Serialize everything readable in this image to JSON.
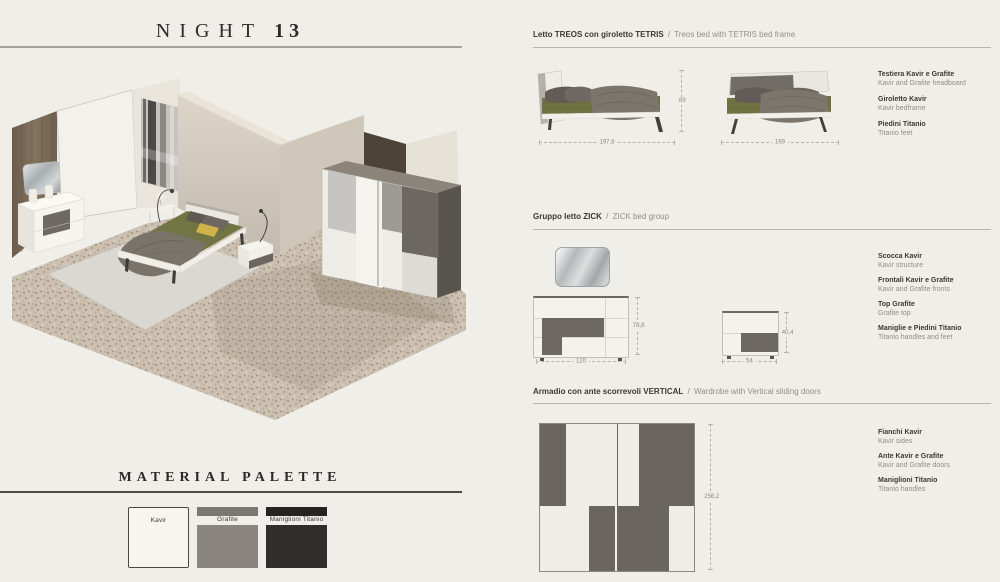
{
  "ui": {
    "sep": "/"
  },
  "title": {
    "text": "NIGHT",
    "number": "13"
  },
  "material_palette": {
    "heading": "MATERIAL PALETTE",
    "swatches": [
      {
        "name": "Kavir",
        "color": "#f7f5f0"
      },
      {
        "name": "Grafite",
        "color": "#8b8580"
      },
      {
        "name": "Maniglioni Titanio",
        "color": "#302e2c"
      }
    ]
  },
  "sections": [
    {
      "title_it": "Letto TREOS con giroletto TETRIS",
      "title_en": "Treos bed with TETRIS bed frame",
      "dims": {
        "side_width": "197,8",
        "height": "89",
        "front_width": "169"
      },
      "labels": [
        {
          "it": "Testiera Kavir e Grafite",
          "en": "Kavir and Grafite headboard"
        },
        {
          "it": "Giroletto Kavir",
          "en": "Kavir bedframe"
        },
        {
          "it": "Piedini Titanio",
          "en": "Titanio feet"
        }
      ]
    },
    {
      "title_it": "Gruppo letto ZICK",
      "title_en": "ZICK bed group",
      "dims": {
        "dresser_height": "78,8",
        "dresser_width": "120",
        "nightstand_height": "40,4",
        "nightstand_width": "54"
      },
      "labels": [
        {
          "it": "Scocca Kavir",
          "en": "Kavir structure"
        },
        {
          "it": "Frontali Kavir e Grafite",
          "en": "Kavir and Grafite fronts"
        },
        {
          "it": "Top Grafite",
          "en": "Grafite top"
        },
        {
          "it": "Maniglie e Piedini Titanio",
          "en": "Titanio handles and feet"
        }
      ]
    },
    {
      "title_it": "Armadio con ante scorrevoli VERTICAL",
      "title_en": "Wardrobe with Vertical sliding doors",
      "dims": {
        "height": "256,2"
      },
      "labels": [
        {
          "it": "Fianchi Kavir",
          "en": "Kavir sides"
        },
        {
          "it": "Ante Kavir e Grafite",
          "en": "Kavir and Grafite doors"
        },
        {
          "it": "Maniglioni Titanio",
          "en": "Titanio handles"
        }
      ]
    }
  ],
  "colors": {
    "background": "#efeee9",
    "kavir": "#f5f3ee",
    "grafite": "#6e6862",
    "titanio": "#302e2c",
    "olive_bedding": "#6f7342",
    "text_dark": "#3a3935",
    "text_gray": "#918e87"
  }
}
